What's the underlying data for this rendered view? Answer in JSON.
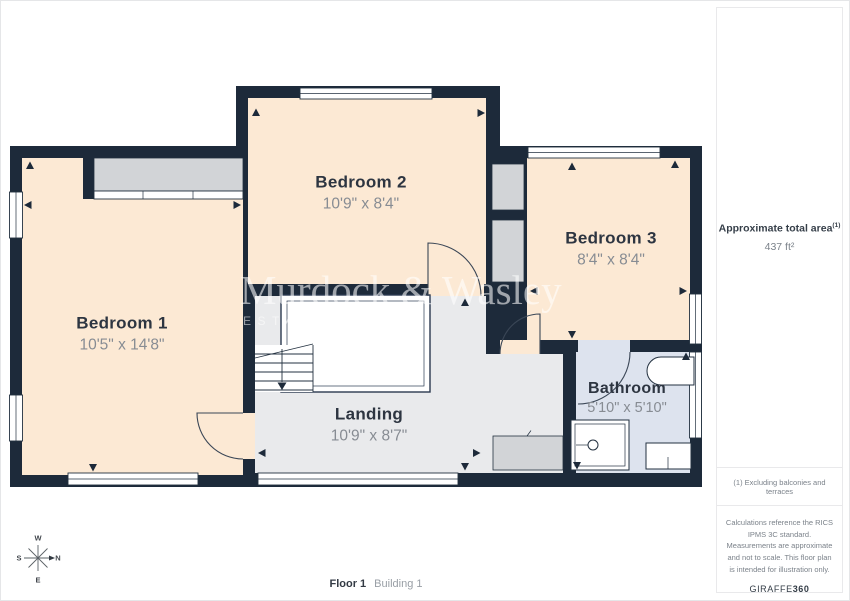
{
  "floor_plan": {
    "rooms": [
      {
        "name": "Bedroom 1",
        "dimensions": "10'5\" x 14'8\""
      },
      {
        "name": "Bedroom 2",
        "dimensions": "10'9\" x 8'4\""
      },
      {
        "name": "Bedroom 3",
        "dimensions": "8'4\" x 8'4\""
      },
      {
        "name": "Landing",
        "dimensions": "10'9\" x 8'7\""
      },
      {
        "name": "Bathroom",
        "dimensions": "5'10\" x 5'10\""
      }
    ],
    "watermark": {
      "name": "Murdock & Wasley",
      "subtitle": "ESTATE AGENTS"
    },
    "compass": {
      "top": "W",
      "right": "N",
      "bottom": "E",
      "left": "S"
    }
  },
  "sidebar": {
    "area_label": "Approximate total area",
    "area_footnote_marker": "(1)",
    "area_value": "437 ft²",
    "footnote": "(1) Excluding balconies and terraces",
    "disclaimer": "Calculations reference the RICS IPMS 3C standard. Measurements are approximate and not to scale. This floor plan is intended for illustration only.",
    "brand": "GIRAFFE",
    "brand_suffix": "360"
  },
  "footer": {
    "floor": "Floor 1",
    "building": "Building 1"
  },
  "colors": {
    "wall": "#1d2a3a",
    "bedroom_fill": "#fce9d4",
    "landing_fill": "#e9eaec",
    "bathroom_fill": "#dde3ee",
    "closet_fill": "#d2d4d7",
    "line": "#233140"
  }
}
